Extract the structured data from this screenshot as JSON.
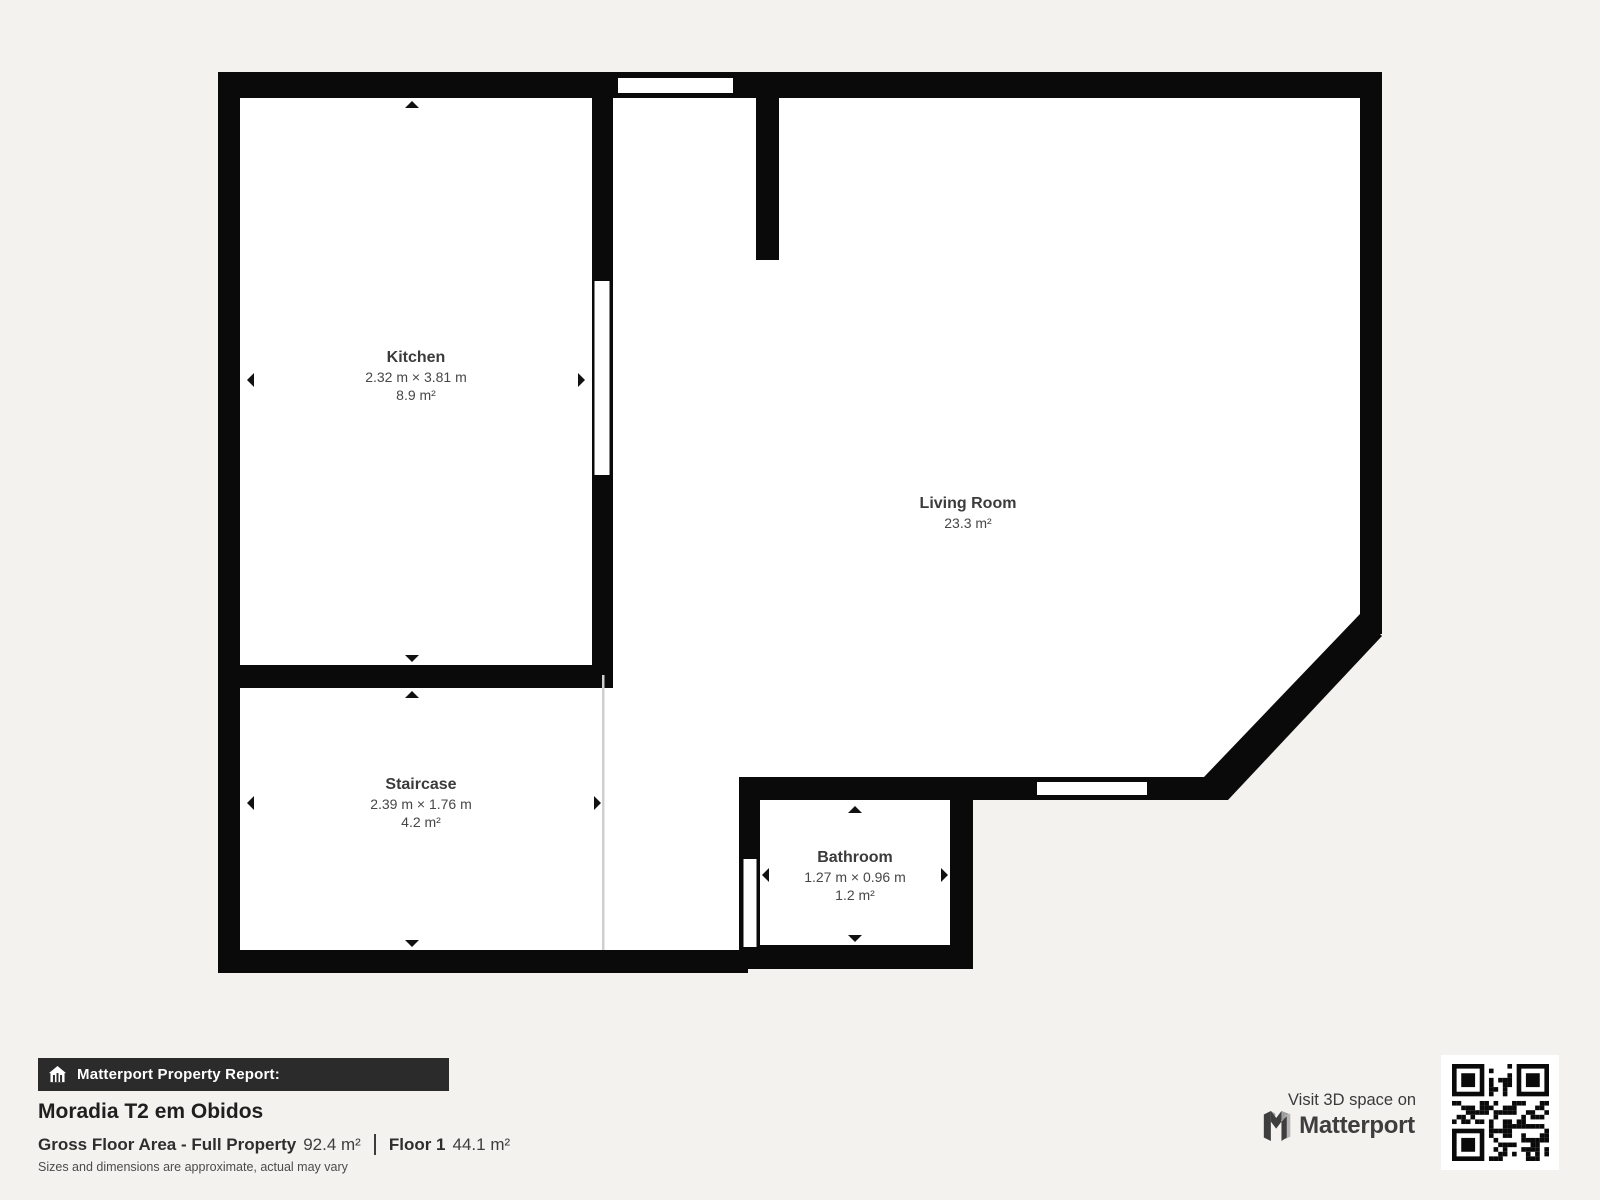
{
  "plan": {
    "rooms": [
      {
        "name": "Kitchen",
        "dimensions": "2.32 m × 3.81 m",
        "area": "8.9 m²"
      },
      {
        "name": "Living Room",
        "dimensions": "",
        "area": "23.3 m²"
      },
      {
        "name": "Staircase",
        "dimensions": "2.39 m × 1.76 m",
        "area": "4.2 m²"
      },
      {
        "name": "Bathroom",
        "dimensions": "1.27 m × 0.96 m",
        "area": "1.2 m²"
      }
    ]
  },
  "report": {
    "bar_label": "Matterport Property Report:",
    "title": "Moradia T2 em Obidos",
    "gross_label": "Gross Floor Area - Full Property",
    "gross_value": "92.4 m²",
    "floor_label": "Floor 1",
    "floor_value": "44.1 m²",
    "disclaimer": "Sizes and dimensions are approximate, actual may vary"
  },
  "branding": {
    "visit_text": "Visit 3D space on",
    "brand_name": "Matterport"
  },
  "colors": {
    "page_background": "#f4f2ef",
    "wall": "#0a0a0a",
    "room_fill": "#ffffff",
    "report_bar": "#2b2b2b",
    "text_dark": "#1f1f1f",
    "text_gray": "#474747",
    "separator_line": "#d0cfcd"
  },
  "icons": {
    "house": "house-icon",
    "matterport_logo": "matterport-logo-icon",
    "qr": "qr-code",
    "dimension_arrows": "arrow-icons"
  }
}
